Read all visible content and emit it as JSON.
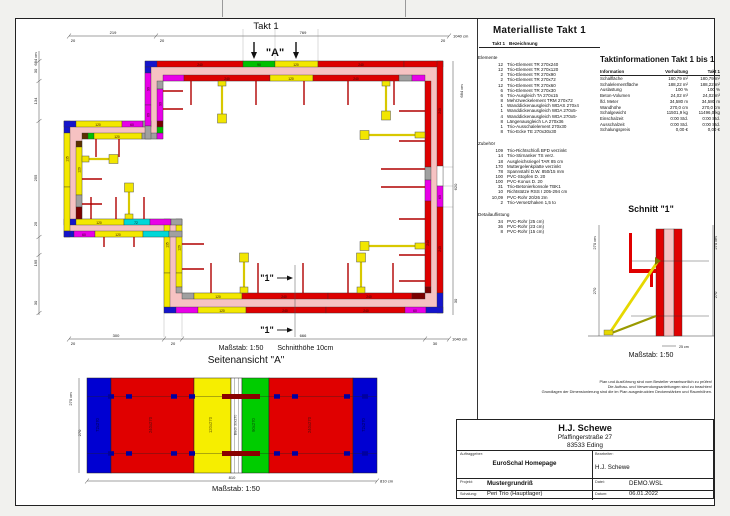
{
  "sheet": {
    "takt_title": "Takt 1"
  },
  "plan": {
    "massstab": "Maßstab: 1:50",
    "schnitthoehe": "Schnitthöhe 10cm",
    "marker_a": "\"A\"",
    "marker_1": "\"1\"",
    "dims": {
      "top": [
        "20",
        "219",
        "20",
        "769",
        "20",
        "1040 cm"
      ],
      "left": [
        "684 cm",
        "30",
        "134",
        "255",
        "25",
        "195",
        "30"
      ],
      "bottom": [
        "20",
        "300",
        "20",
        "666",
        "30",
        "1040 cm"
      ],
      "right": [
        "684 cm",
        "620",
        "30"
      ]
    },
    "labels": [
      "240",
      "90",
      "120",
      "240",
      "240",
      "120",
      "240",
      "240",
      "60",
      "240",
      "240",
      "120",
      "240",
      "240",
      "60",
      "120",
      "240",
      "240",
      "135",
      "120",
      "120",
      "72",
      "60",
      "120",
      "135",
      "120",
      "120",
      "60",
      "120",
      "90",
      "60",
      "90"
    ]
  },
  "seitenansicht": {
    "title": "Seitenansicht \"A\"",
    "massstab": "Maßstab: 1:50",
    "dim_height": "270 cm",
    "dim_height_inner": "270",
    "dim_width": "810",
    "dim_width_total": "810 cm",
    "panels": [
      {
        "label": "72x270",
        "color": "#0000d2"
      },
      {
        "label": "240x270",
        "color": "#e00000"
      },
      {
        "label": "120x270",
        "color": "#f6ee00"
      },
      {
        "label": "Blech 30x270",
        "color": "#ffffff"
      },
      {
        "label": "90x270",
        "color": "#00cc00"
      },
      {
        "label": "240x270",
        "color": "#e00000"
      },
      {
        "label": "72x270",
        "color": "#0000d2"
      }
    ]
  },
  "materialliste": {
    "title": "Materialliste  Takt 1",
    "col_qty": "Takt 1",
    "col_desc": "Bezeichnung",
    "groups": [
      {
        "name": "Elemente",
        "items": [
          {
            "qty": "12",
            "desc": "Trio-Element TR 270x240"
          },
          {
            "qty": "12",
            "desc": "Trio-Element TR 270x120"
          },
          {
            "qty": "2",
            "desc": "Trio-Element TR 270x90"
          },
          {
            "qty": "2",
            "desc": "Trio-Element TR 270x72"
          },
          {
            "qty": "12",
            "desc": "Trio-Element TR 270x60"
          },
          {
            "qty": "6",
            "desc": "Trio-Element TR 270x30"
          },
          {
            "qty": "6",
            "desc": "Trio-Ausgleich TA 270x15"
          },
          {
            "qty": "8",
            "desc": "Mehrzweckelement TRM 270x72"
          },
          {
            "qty": "1",
            "desc": "Wanddickenausgleich WDAS 270x4"
          },
          {
            "qty": "1",
            "desc": "Wanddickenausgleich WDA 270x5-"
          },
          {
            "qty": "4",
            "desc": "Wanddickenausgleich WDA 270x5-"
          },
          {
            "qty": "8",
            "desc": "Längenausgleich LA 270x36"
          },
          {
            "qty": "1",
            "desc": "Trio-Ausschalelement 270x30"
          },
          {
            "qty": "8",
            "desc": "Trio-Ecke TE 270x30x30"
          }
        ]
      },
      {
        "name": "Zubehör",
        "items": [
          {
            "qty": "109",
            "desc": "Trio-Richtschloß BFD verzinkt"
          },
          {
            "qty": "14",
            "desc": "Trio-Stirnanker TS verz."
          },
          {
            "qty": "18",
            "desc": "Ausgleichsriegel TAR 85 cm"
          },
          {
            "qty": "170",
            "desc": "Muttergelenkplatte verzinkt"
          },
          {
            "qty": "78",
            "desc": "Spannstahl D.W. 850/15 mm"
          },
          {
            "qty": "100",
            "desc": "PVC-Stopfen D. 20"
          },
          {
            "qty": "100",
            "desc": "PVC-Konus D. 20"
          },
          {
            "qty": "31",
            "desc": "Trio-Betonierkonsole TBK1"
          },
          {
            "qty": "10",
            "desc": "Richtstütze RSS I 205-294 cm"
          },
          {
            "qty": "10,09",
            "desc": "PVC-Rohr 20/26  2m"
          },
          {
            "qty": "2",
            "desc": "Trio-Versetzhaken 1,5 to"
          }
        ]
      },
      {
        "name": "Detailauflistung",
        "items": [
          {
            "qty": "34",
            "desc": "PVC-Rohr  (25 cm)"
          },
          {
            "qty": "36",
            "desc": "PVC-Rohr  (23 cm)"
          },
          {
            "qty": "8",
            "desc": "PVC-Rohr  (15 cm)"
          }
        ]
      }
    ]
  },
  "taktinfo": {
    "title": "Taktinformationen  Takt 1 bis 1",
    "cols": [
      "Information",
      "Vorhaltung",
      "Takt 1"
    ],
    "rows": [
      [
        "Schalfläche",
        "180,79 m²",
        "180,79 m²"
      ],
      [
        "Schalelementfläche",
        "188,22 m²",
        "188,22 m²"
      ],
      [
        "Auslastung",
        "100 %",
        "100 %"
      ],
      [
        "Beton-Volumen",
        "24,02 m³",
        "24,02 m³"
      ],
      [
        "lfd. Meter",
        "34,580 m",
        "34,580 m"
      ],
      [
        "Wandhöhe",
        "270,0 cm",
        "270,0 cm"
      ],
      [
        "Schalgewicht",
        "11501,9 kg",
        "11496,0 kg"
      ],
      [
        "Einschalzeit",
        "0:00 Std.",
        "0:00 Std."
      ],
      [
        "Ausschalzeit",
        "0:00 Std.",
        "0:00 Std."
      ],
      [
        "Schalungspreis",
        "0,00 €",
        "0,00 €"
      ]
    ]
  },
  "schnitt": {
    "title": "Schnitt \"1\"",
    "massstab": "Maßstab: 1:50",
    "dim_left": "270 cm",
    "dim_left_inner": "270",
    "dim_right": "270 cm",
    "dim_right_inner": "270",
    "dim_wall": "25 cm"
  },
  "disclaimer": {
    "line1": "Plan und Ausführung sind vom Besteller verantwortlich zu prüfen!",
    "line2": "Die Aufbau- und Verwendungsanleitungen sind zu beachten!",
    "line3": "Grundlagen der Dimensionierung sind die im Plan ausgedruckten Deckenstärken und Raumhöhen."
  },
  "titleblock": {
    "name": "H.J. Schewe",
    "street": "Pfaffingerstraße 27",
    "city": "83533 Eding",
    "auftraggeber_label": "Auftraggeber:",
    "auftraggeber": "EuroSchal Homepage",
    "bearbeiter_label": "Bearbeiter:",
    "bearbeiter": "H.J. Schewe",
    "projekt_label": "Projekt:",
    "projekt": "Mustergrundriß",
    "datei_label": "Datei:",
    "datei": "DEMO.WSL",
    "schalung_label": "Schalung:",
    "schalung": "Peri Trio (Hauptlager)",
    "datum_label": "Datum:",
    "datum": "06.01.2022"
  }
}
